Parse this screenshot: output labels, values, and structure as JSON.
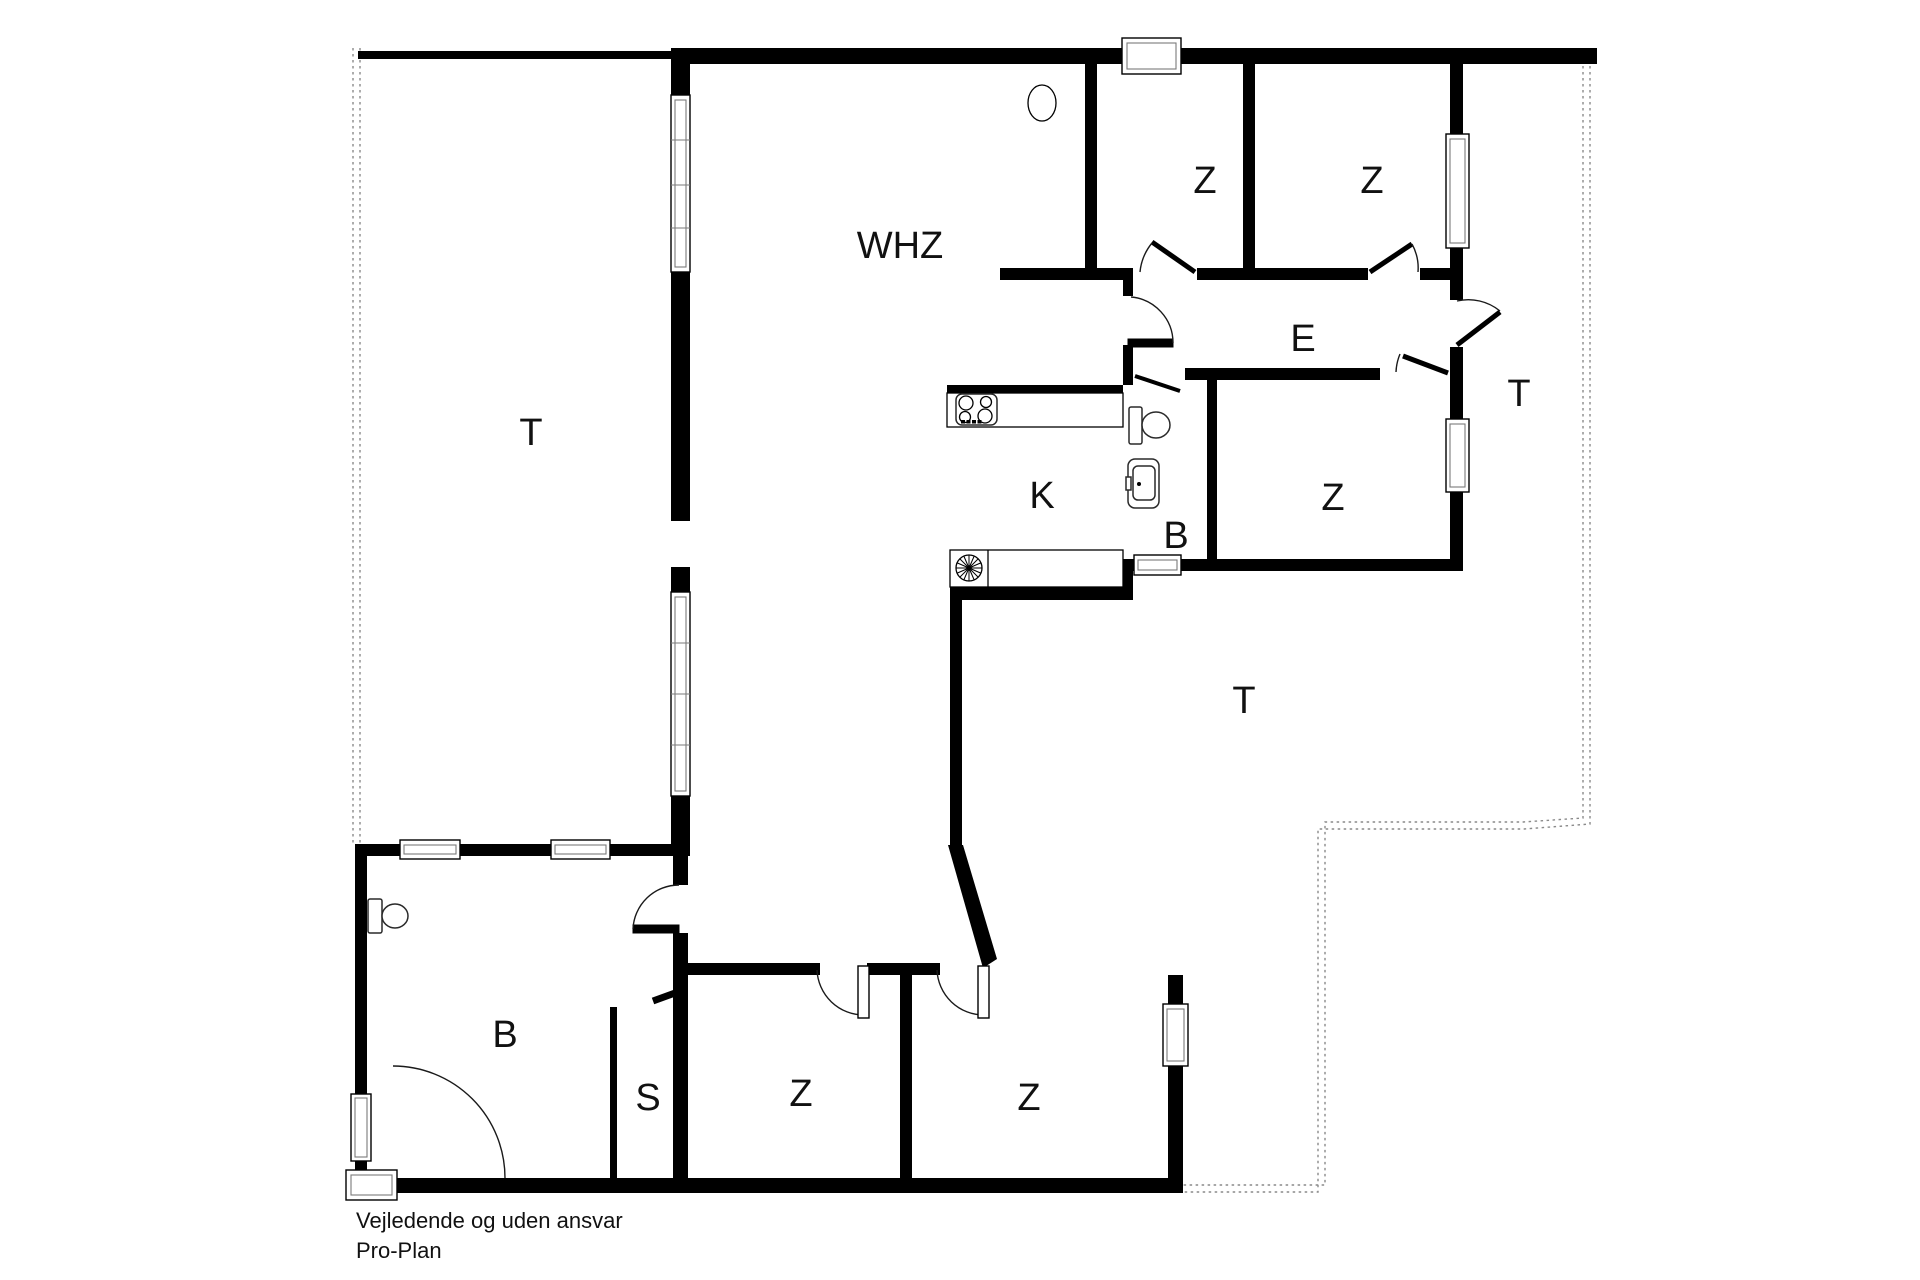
{
  "labels": {
    "terrace_left": "T",
    "living_room": "WHZ",
    "bedroom_top_left": "Z",
    "bedroom_top_right": "Z",
    "hall": "E",
    "terrace_right": "T",
    "kitchen": "K",
    "bath_middle": "B",
    "bedroom_middle": "Z",
    "terrace_middle": "T",
    "bath_main": "B",
    "storage": "S",
    "bedroom_bottom_left": "Z",
    "bedroom_bottom_right": "Z"
  },
  "footer": {
    "line1": "Vejledende og uden ansvar",
    "line2": "Pro-Plan"
  },
  "colors": {
    "wall": "#000000",
    "background": "#ffffff",
    "boundary_dotted": "#8a8a8a"
  },
  "icons": {
    "stove-icon": "four-burner cooktop",
    "extractor-fan-icon": "radial fan in counter",
    "toilet-icon": "toilet with cistern",
    "sink-icon": "wash basin",
    "ceiling-lamp-icon": "oval lamp outline",
    "window-icon": "double-framed window in wall",
    "door-swing-icon": "quarter-circle door swing"
  }
}
